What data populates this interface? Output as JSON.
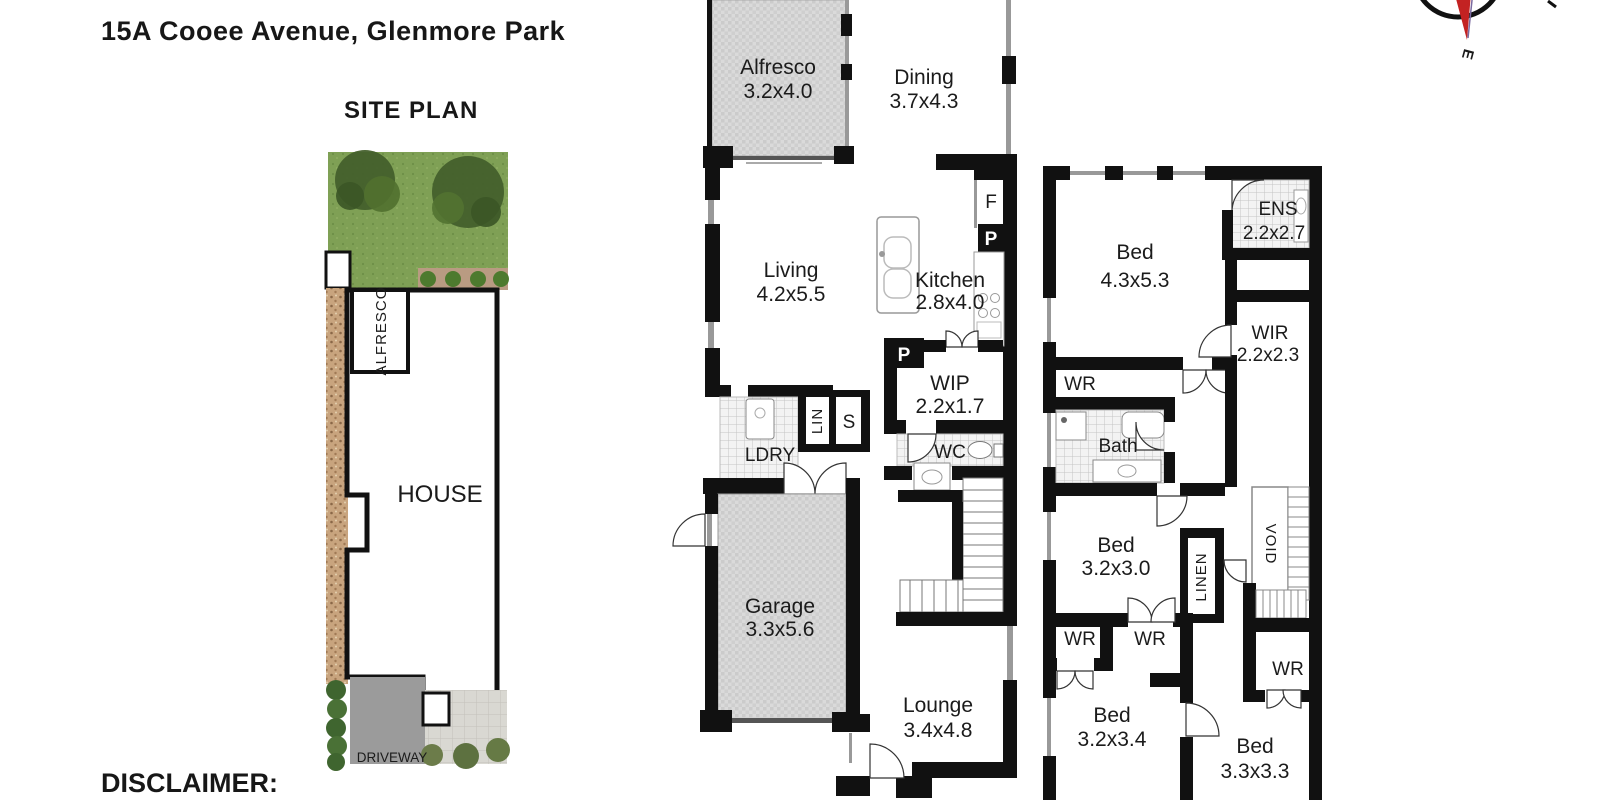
{
  "page": {
    "title": "15A Cooee Avenue, Glenmore Park",
    "disclaimer": "DISCLAIMER:"
  },
  "compass": {
    "east": "E"
  },
  "site_plan": {
    "heading": "SITE PLAN",
    "labels": {
      "alfresco": "ALFRESCO",
      "house": "HOUSE",
      "driveway": "DRIVEWAY"
    }
  },
  "ground_floor": {
    "alfresco_name": "Alfresco",
    "alfresco_dims": "3.2x4.0",
    "dining_name": "Dining",
    "dining_dims": "3.7x4.3",
    "living_name": "Living",
    "living_dims": "4.2x5.5",
    "kitchen_name": "Kitchen",
    "kitchen_dims": "2.8x4.0",
    "wip_name": "WIP",
    "wip_dims": "2.2x1.7",
    "wc": "WC",
    "ldry": "LDRY",
    "lin": "LIN",
    "store": "S",
    "fridge": "F",
    "pantry_kitchen": "P",
    "pantry_wip": "P",
    "garage_name": "Garage",
    "garage_dims": "3.3x5.6",
    "lounge_name": "Lounge",
    "lounge_dims": "3.4x4.8"
  },
  "first_floor": {
    "ens_name": "ENS",
    "ens_dims": "2.2x2.7",
    "bed1_name": "Bed",
    "bed1_dims": "4.3x5.3",
    "wir_name": "WIR",
    "wir_dims": "2.2x2.3",
    "wr_master": "WR",
    "bath": "Bath",
    "bed2_name": "Bed",
    "bed2_dims": "3.2x3.0",
    "linen": "LINEN",
    "void": "VOID",
    "wr_left": "WR",
    "wr_mid": "WR",
    "bed3_name": "Bed",
    "bed3_dims": "3.2x3.4",
    "wr_right": "WR",
    "bed4_name": "Bed",
    "bed4_dims": "3.3x3.3"
  },
  "colors": {
    "wall": "#111111",
    "hatch_fill": "#d9d9d9",
    "wet_area_fill": "#f3f3f3",
    "grass": "#7fa055",
    "tree": "#44602c",
    "gravel": "#c8a47e",
    "driveway": "#9b9b9b",
    "paving": "#d9d8d2",
    "compass_needle": "#c32222"
  }
}
